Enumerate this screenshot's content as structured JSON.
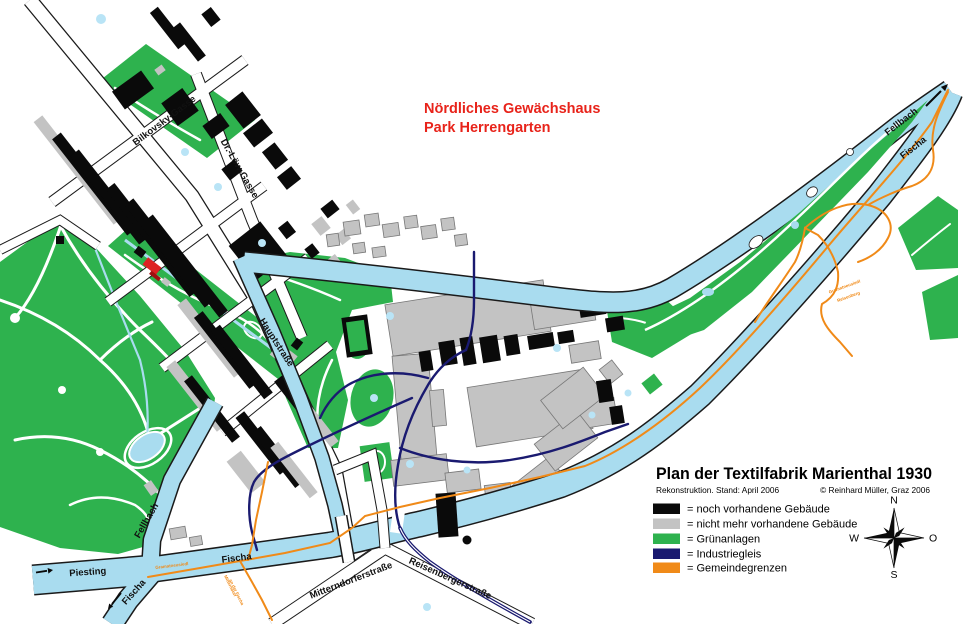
{
  "title_block": {
    "title": "Plan der Textilfabrik Marienthal 1930",
    "subtitle_left": "Rekonstruktion. Stand: April 2006",
    "subtitle_right": "© Reinhard Müller, Graz 2006"
  },
  "legend": {
    "items": [
      {
        "label": "= noch vorhandene Gebäude",
        "color": "#0a0a0a"
      },
      {
        "label": "= nicht mehr vorhandene Gebäude",
        "color": "#c3c3c3"
      },
      {
        "label": "= Grünanlagen",
        "color": "#2eb24e"
      },
      {
        "label": "= Industriegleis",
        "color": "#1a1a70"
      },
      {
        "label": "= Gemeindegrenzen",
        "color": "#f08a18"
      }
    ]
  },
  "annotation": {
    "line1": "Nördliches Gewächshaus",
    "line2": "Park Herrengarten",
    "color": "#e8231a"
  },
  "streets": {
    "bilkovsky": "Bilkovsky-Gasse",
    "dr_loew": "Dr.-Löw-Gasse",
    "hauptstrasse": "Hauptstraße",
    "mitterndorferstrasse": "Mitterndorferstraße",
    "reisenbergerstrasse": "Reisenbergerstraße"
  },
  "waters": {
    "piesting": "Piesting",
    "fellbach_sw": "Fellbach",
    "fischa_south": "Fischa",
    "fischa_east": "Fischa",
    "fellbach_ne": "Fellbach",
    "fischa_ne": "Fischa"
  },
  "boundaries": {
    "gramatneusiedl": "Gramatneusiedl",
    "south_line1": "Mitterndorf",
    "south_line2": "an der Fischa",
    "ne_line1": "Gramatneusiedl",
    "ne_line2": "Reisenberg"
  },
  "compass": {
    "north": "N",
    "east": "O",
    "south": "S",
    "west": "W"
  },
  "colors": {
    "water": "#a9dcef",
    "park": "#2eb24e",
    "building_existing": "#0a0a0a",
    "building_gone": "#c3c3c3",
    "rail": "#1a1a70",
    "boundary": "#f08a18"
  }
}
